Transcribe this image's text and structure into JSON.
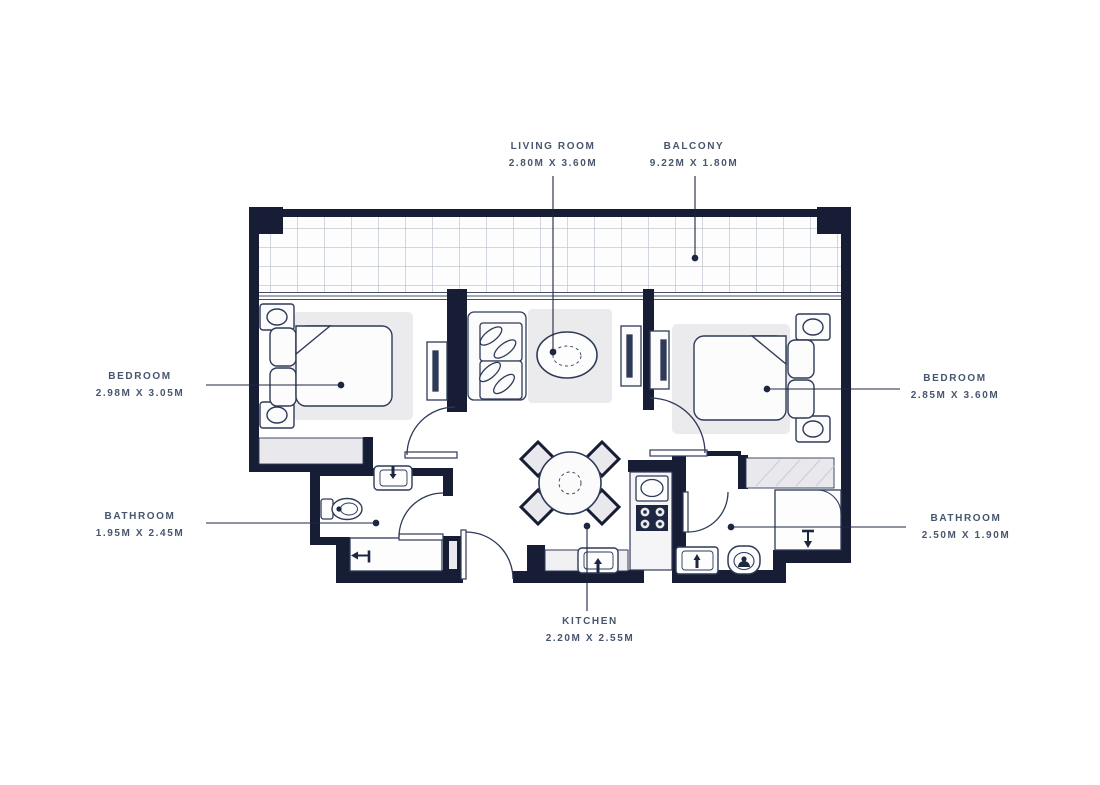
{
  "colors": {
    "wall": "#161d35",
    "furniture_line": "#2e3a57",
    "light_fill": "#ebebee",
    "grid_line": "#b7bdc9",
    "label_text": "#47566f",
    "background": "#ffffff"
  },
  "labels": {
    "living_room": {
      "name": "LIVING ROOM",
      "dims": "2.80M X 3.60M"
    },
    "balcony": {
      "name": "BALCONY",
      "dims": "9.22M X 1.80M"
    },
    "bedroom_left": {
      "name": "BEDROOM",
      "dims": "2.98M X 3.05M"
    },
    "bedroom_right": {
      "name": "BEDROOM",
      "dims": "2.85M X 3.60M"
    },
    "bathroom_left": {
      "name": "BATHROOM",
      "dims": "1.95M X 2.45M"
    },
    "bathroom_right": {
      "name": "BATHROOM",
      "dims": "2.50M X 1.90M"
    },
    "kitchen": {
      "name": "KITCHEN",
      "dims": "2.20M X 2.55M"
    }
  }
}
